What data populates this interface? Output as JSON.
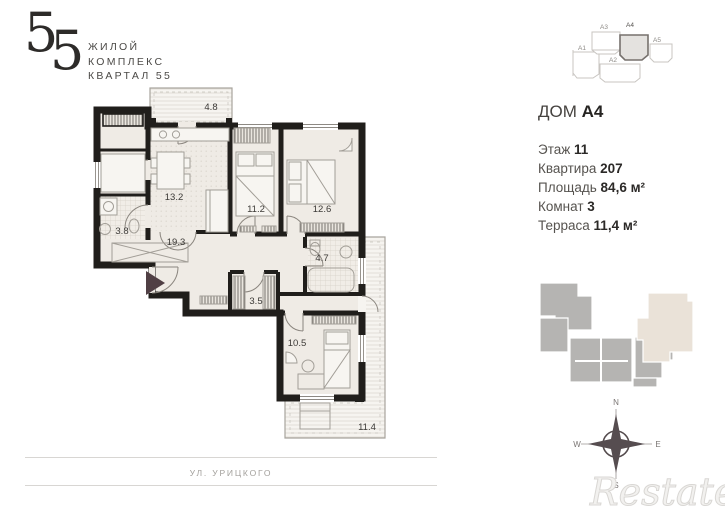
{
  "logo": {
    "number_left": "5",
    "number_right": "5",
    "line1": "ЖИЛОЙ",
    "line2": "КОМПЛЕКС",
    "line3": "КВАРТАЛ 55"
  },
  "info": {
    "house_label": "ДОМ",
    "house_value": "A4",
    "rows": [
      {
        "label": "Этаж",
        "value": "11"
      },
      {
        "label": "Квартира",
        "value": "207"
      },
      {
        "label": "Площадь",
        "value": "84,6 м²"
      },
      {
        "label": "Комнат",
        "value": "3"
      },
      {
        "label": "Терраса",
        "value": "11,4 м²"
      }
    ]
  },
  "plan": {
    "rooms": [
      {
        "name": "balcony",
        "area": "4.8"
      },
      {
        "name": "kitchen-living",
        "area": "13.2"
      },
      {
        "name": "bedroom-1",
        "area": "11.2"
      },
      {
        "name": "bedroom-2",
        "area": "12.6"
      },
      {
        "name": "bathroom-small",
        "area": "3.8"
      },
      {
        "name": "hall",
        "area": "19.3"
      },
      {
        "name": "bathroom",
        "area": "4.7"
      },
      {
        "name": "wardrobe",
        "area": "3.5"
      },
      {
        "name": "bedroom-3",
        "area": "10.5"
      },
      {
        "name": "terrace",
        "area": "11.4"
      }
    ]
  },
  "site_top": {
    "labels": [
      "A1",
      "A2",
      "A3",
      "A4",
      "A5"
    ],
    "highlighted": "A4"
  },
  "compass": {
    "n": "N",
    "s": "S",
    "w": "W",
    "e": "E"
  },
  "street_label": "УЛ. УРИЦКОГО",
  "watermark": "Restate",
  "colors": {
    "wall": "#201e1b",
    "floor": "#efebe5",
    "terrace_fill": "#f6f4f0",
    "entry_arrow": "#503f44",
    "site_gray": "#b5b4b2",
    "site_beige": "#eae2d8",
    "furniture_stroke": "#a29e97"
  }
}
